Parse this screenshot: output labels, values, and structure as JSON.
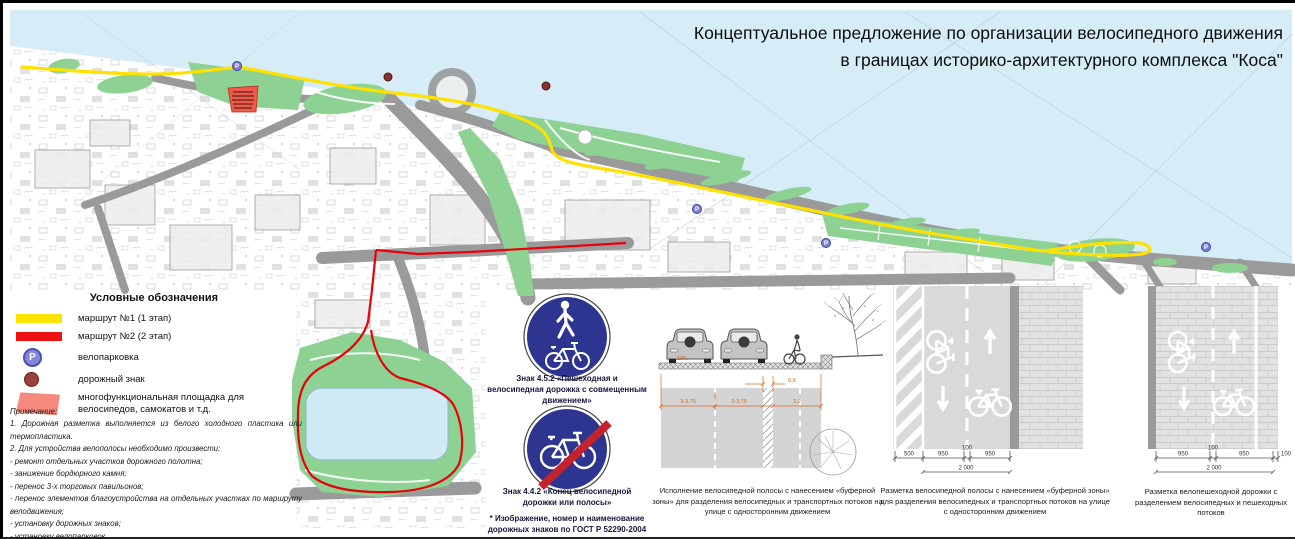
{
  "title": {
    "line1": "Концептуальное предложение по организации велосипедного движения",
    "line2": "в границах историко-архитектурного комплекса \"Коса\""
  },
  "legend": {
    "title": "Условные обозначения",
    "items": [
      {
        "label": "маршрут №1 (1 этап)"
      },
      {
        "label": "маршрут №2 (2 этап)"
      },
      {
        "label": "велопарковка"
      },
      {
        "label": "дорожный знак"
      },
      {
        "label": "многофункциональная площадка для велосипедов, самокатов и т.д."
      }
    ]
  },
  "notes": {
    "heading": "Примечание:",
    "lines": [
      "1. Дорожная разметка выполняется из белого холодного пластика или термопластика.",
      "2. Для устройства велополосы необходимо произвести:",
      "- ремонт отдельных участков дорожного полотна;",
      "- занижение бордюрного камня;",
      "- перенос 3-х торговых павильонов;",
      "- перенос элементов благоустройства на отдельных участках по маршруту велодвижения;",
      "- установку дорожных знаков;",
      "- установку велопарковок."
    ]
  },
  "signs": {
    "sign1_caption": "Знак 4.5.2 «Пешеходная и велосипедная дорожка с совмещенным движением»",
    "sign2_caption": "Знак 4.4.2 «Конец велосипедной дорожки или полосы»",
    "gost_note": "* Изображение, номер и наименование дорожных знаков по ГОСТ Р 52290-2004"
  },
  "cross_section": {
    "slope": "20‰",
    "dim_lane1": "3-3,75",
    "dim_lane2": "3-3,75",
    "dim_buffer": "0,6",
    "dim_bike": "2,2",
    "caption": "Исполнение велосипедной полосы с нанесением «буферной зоны» для разделения велосипедных и транспортных потоков на улице с односторонним движением"
  },
  "diagram1": {
    "dims": [
      "500",
      "950",
      "100",
      "950"
    ],
    "total": "2 000",
    "caption": "Разметка велосипедной полосы с нанесением «буферной зоны» для разделения велосипедных и транспортных потоков на улице с односторонним движением"
  },
  "diagram2": {
    "dims": [
      "950",
      "100",
      "950",
      "100"
    ],
    "total": "2 000",
    "caption": "Разметка велопешеходной дорожки с разделением велосипедных и пешеходных потоков"
  },
  "glyphs": {
    "parking": "P"
  },
  "colors": {
    "route1": "#ffe100",
    "route2": "#e8000b",
    "water": "#d6edf8",
    "green": "#8dd293",
    "road_gray": "#9a9a9a",
    "sign_blue": "#2e3590",
    "sign_red": "#c4232b",
    "dim_orange": "#c9661f",
    "parking_marker": "#7d81d4",
    "sign_marker": "#8c2f2f",
    "platform": "#f15a4a"
  }
}
